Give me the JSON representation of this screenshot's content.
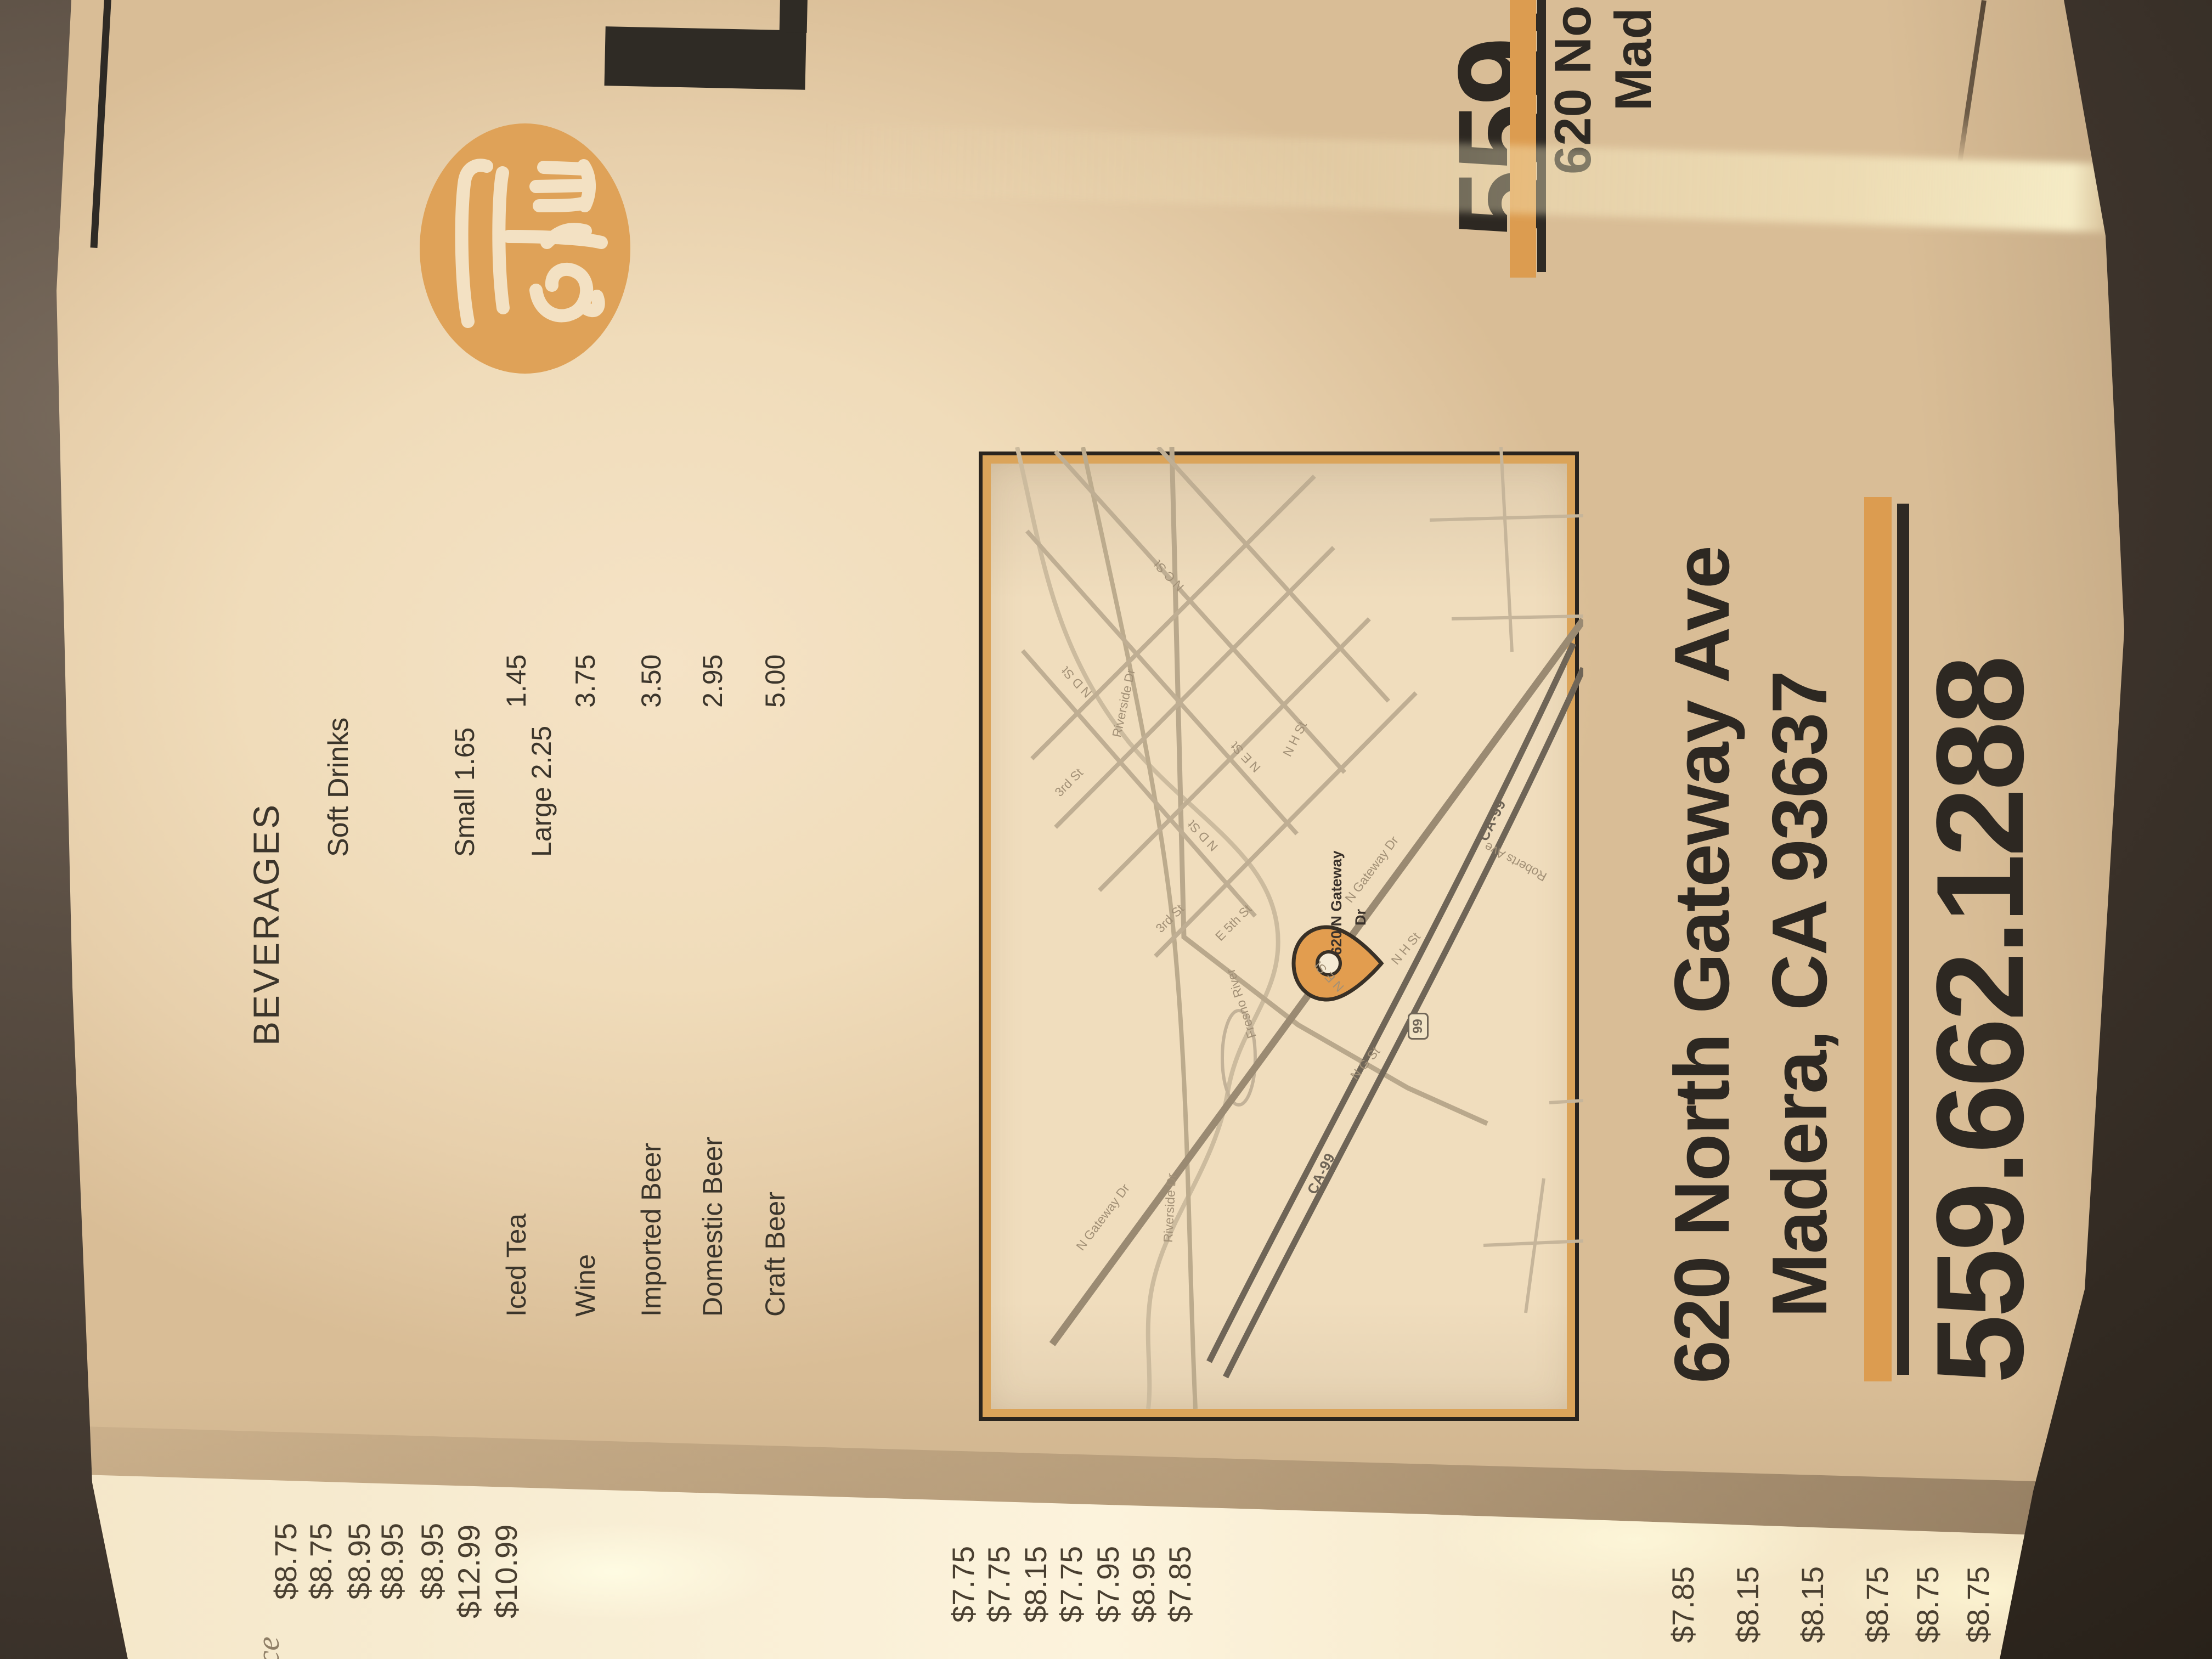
{
  "menu": {
    "cover": {
      "partial_title_letter": "L",
      "phone_partial": "559.",
      "address_line1_partial": "620 No",
      "address_line2_partial": "Mad"
    },
    "beverages": {
      "heading": "BEVERAGES",
      "soft_drinks_label": "Soft Drinks",
      "soft_drinks_small": "Small 1.65",
      "soft_drinks_large": "Large 2.25",
      "items": [
        {
          "name": "Iced Tea",
          "price": "1.45"
        },
        {
          "name": "Wine",
          "price": "3.75"
        },
        {
          "name": "Imported Beer",
          "price": "3.50"
        },
        {
          "name": "Domestic Beer",
          "price": "2.95"
        },
        {
          "name": "Craft Beer",
          "price": "5.00"
        }
      ]
    },
    "map": {
      "pin_label_line1": "620 N Gateway",
      "pin_label_line2": "Dr",
      "highway_shield": "99",
      "street_labels": [
        "N Gateway Dr",
        "N Gateway Dr",
        "CA-99",
        "CA-99",
        "Riverside Dr",
        "Riverside Dr",
        "Fresno River",
        "3rd St",
        "3rd St",
        "N D St",
        "N D St",
        "N E St",
        "N E St",
        "N C St",
        "N G St",
        "N H St",
        "N H St",
        "E 5th St",
        "Roberts Ave"
      ]
    },
    "contact": {
      "address_line1": "620 North Gateway Ave",
      "address_line2": "Madera, CA 93637",
      "phone": "559.662.1288"
    },
    "partial_prices_left": [
      "$8.75",
      "$8.75",
      "$8.95",
      "$8.95",
      "$8.95",
      "$12.99",
      "$10.99"
    ],
    "partial_prices_center": [
      "$7.75",
      "$7.75",
      "$8.15",
      "$7.75",
      "$7.95",
      "$8.95",
      "$7.85"
    ],
    "partial_prices_right": [
      "$7.85",
      "$8.15",
      "$8.15",
      "$8.75",
      "$8.75",
      "$8.75",
      "$8.75"
    ],
    "partial_item_text": "Rice",
    "colors": {
      "accent_orange": "#dd9e54",
      "ink": "#2d2822",
      "paper": "#f2e0c2"
    }
  }
}
